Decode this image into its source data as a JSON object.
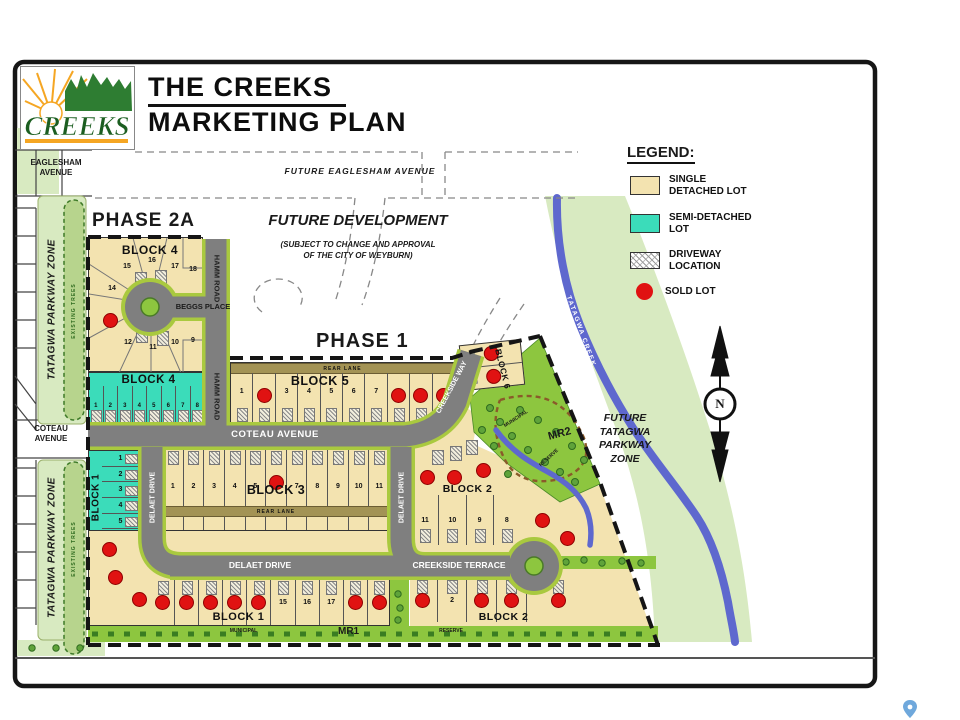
{
  "colors": {
    "single": "#F3E3B0",
    "semi": "#3BDCBA",
    "sold": "#E01212",
    "road": "#7F7F7F",
    "verge": "#A9C93F",
    "parkway": "#D8EAC1",
    "reserve": "#8DC63F",
    "creek": "#5E68CE",
    "lane": "#A39355",
    "pin": "#6FA8DC",
    "tree": "#5FA33A",
    "tree_dark": "#2F6B1F",
    "logo_green": "#1B5E20"
  },
  "header": {
    "title_line1": "THE CREEKS",
    "title_line2": "MARKETING PLAN",
    "logo_text": "CREEKS"
  },
  "legend": {
    "title": "LEGEND:",
    "single": {
      "label1": "SINGLE",
      "label2": "DETACHED LOT"
    },
    "semi": {
      "label1": "SEMI-DETACHED",
      "label2": "LOT"
    },
    "driveway": {
      "label1": "DRIVEWAY",
      "label2": "LOCATION"
    },
    "sold": {
      "label1": "SOLD LOT"
    }
  },
  "labels": {
    "phase2a": "PHASE 2A",
    "phase1": "PHASE 1",
    "future_dev1": "FUTURE DEVELOPMENT",
    "future_dev2": "(SUBJECT TO CHANGE AND APPROVAL",
    "future_dev3": "OF THE CITY OF WEYBURN)",
    "future_eaglesham": "FUTURE EAGLESHAM AVENUE",
    "eaglesham1": "EAGLESHAM",
    "eaglesham2": "AVENUE",
    "coteau1": "COTEAU",
    "coteau2": "AVENUE",
    "coteau_avenue": "COTEAU AVENUE",
    "hamm_road": "HAMM ROAD",
    "beggs_place": "BEGGS PLACE",
    "delaet_drive": "DELAET DRIVE",
    "creekside_way": "CREEKSIDE WAY",
    "creekside_terrace": "CREEKSIDE TERRACE",
    "rear_lane": "REAR LANE",
    "tatagwa_zone": "TATAGWA PARKWAY ZONE",
    "existing_trees": "EXISTING TREES",
    "tatagwa_creek": "TATAGWA CREEK",
    "future_zone1": "FUTURE",
    "future_zone2": "TATAGWA",
    "future_zone3": "PARKWAY",
    "future_zone4": "ZONE",
    "mr1": "MR1",
    "mr2": "MR2",
    "municipal": "MUNICIPAL",
    "reserve": "RESERVE",
    "compass_n": "N"
  },
  "blocks": {
    "block4_tan": {
      "label": "BLOCK 4",
      "lots": [
        {
          "n": 15
        },
        {
          "n": 16
        },
        {
          "n": 17
        },
        {
          "n": 18
        },
        {
          "n": 14
        },
        {
          "n": 13,
          "sold": true
        },
        {
          "n": 12
        },
        {
          "n": 11
        },
        {
          "n": 10
        },
        {
          "n": 9
        }
      ]
    },
    "block4_teal": {
      "label": "BLOCK 4",
      "lots": [
        {
          "n": 1
        },
        {
          "n": 2
        },
        {
          "n": 3
        },
        {
          "n": 4
        },
        {
          "n": 5
        },
        {
          "n": 6
        },
        {
          "n": 7
        },
        {
          "n": 8
        }
      ]
    },
    "block5": {
      "label": "BLOCK 5",
      "lots": [
        {
          "n": 1
        },
        {
          "n": 2,
          "sold": true
        },
        {
          "n": 3
        },
        {
          "n": 4
        },
        {
          "n": 5
        },
        {
          "n": 6
        },
        {
          "n": 7
        },
        {
          "n": 8,
          "sold": true
        },
        {
          "n": 9,
          "sold": true
        },
        {
          "n": 10,
          "sold": true
        }
      ]
    },
    "block3": {
      "label": "BLOCK 3",
      "lots_top": [
        {
          "n": 1
        },
        {
          "n": 2
        },
        {
          "n": 3
        },
        {
          "n": 4
        },
        {
          "n": 5
        },
        {
          "n": 6,
          "sold": true
        },
        {
          "n": 7
        },
        {
          "n": 8
        },
        {
          "n": 9
        },
        {
          "n": 10
        },
        {
          "n": 11
        }
      ],
      "lots_bottom": [
        {
          "n": 22,
          "sold": true
        },
        {
          "n": 21
        },
        {
          "n": 20
        },
        {
          "n": 19
        },
        {
          "n": 18
        },
        {
          "n": 17,
          "sold": true
        },
        {
          "n": 16
        },
        {
          "n": 15
        },
        {
          "n": 14
        },
        {
          "n": 13
        },
        {
          "n": 12
        }
      ]
    },
    "block1_teal": {
      "label": "BLOCK 1",
      "lots": [
        {
          "n": 1
        },
        {
          "n": 2
        },
        {
          "n": 3
        },
        {
          "n": 4
        },
        {
          "n": 5
        },
        {
          "n": 6
        }
      ]
    },
    "block1_tan": {
      "label": "BLOCK 1",
      "lots_curve": [
        {
          "n": 7,
          "sold": true
        },
        {
          "n": 8,
          "sold": true
        },
        {
          "n": 9,
          "sold": true
        }
      ],
      "lots_row": [
        {
          "n": 10,
          "sold": true
        },
        {
          "n": 11,
          "sold": true
        },
        {
          "n": 12,
          "sold": true
        },
        {
          "n": 13,
          "sold": true
        },
        {
          "n": 14,
          "sold": true
        },
        {
          "n": 15
        },
        {
          "n": 16
        },
        {
          "n": 17
        },
        {
          "n": 18,
          "sold": true
        },
        {
          "n": 19,
          "sold": true
        }
      ]
    },
    "block2": {
      "label_upper": "BLOCK 2",
      "label_lower": "BLOCK 2",
      "lots_upper": [
        {
          "n": 12,
          "sold": true
        },
        {
          "n": 13,
          "sold": true
        },
        {
          "n": 14,
          "sold": true
        }
      ],
      "lots_mid": [
        {
          "n": 11
        },
        {
          "n": 10
        },
        {
          "n": 9
        },
        {
          "n": 8
        }
      ],
      "lots_diag": [
        {
          "n": 6,
          "sold": true
        },
        {
          "n": 7,
          "sold": true
        }
      ],
      "lots_lower": [
        {
          "n": 1,
          "sold": true
        },
        {
          "n": 2
        },
        {
          "n": 3,
          "sold": true
        },
        {
          "n": 4,
          "sold": true
        },
        {
          "n": 5,
          "sold": true
        }
      ]
    },
    "block6": {
      "label": "BLOCK 6",
      "lots": [
        {
          "sold": true
        },
        {
          "sold": true
        }
      ]
    }
  }
}
